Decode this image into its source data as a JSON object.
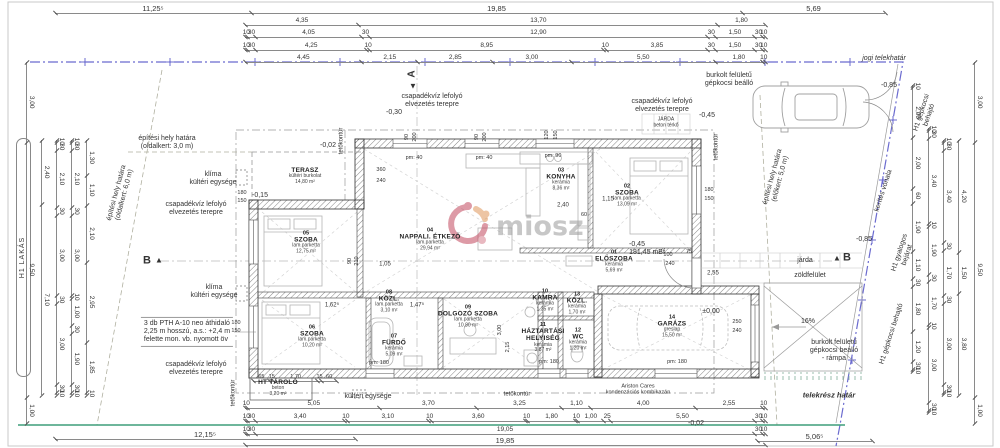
{
  "watermark": {
    "text": "miosz"
  },
  "left_pill": {
    "text": "H1 LAKÁS"
  },
  "palette": {
    "boundary_blue": "#6b6bcf",
    "terrain_green": "#3f9e7a",
    "wall_line": "#333333",
    "dim_line": "#8a8a8a",
    "furniture_gray": "#b5b5b5",
    "logo_red": "#c2485e",
    "logo_orange": "#e0975a",
    "logo_rose": "#d77f8d",
    "watermark_gray": "#9a9a9a"
  },
  "rooms": [
    {
      "num": "",
      "name": "TERASZ",
      "finish": "kültéri burkolat",
      "area": "14,80 m²",
      "x": 305,
      "y": 176
    },
    {
      "num": "05",
      "name": "SZOBA",
      "finish": "lam.parketta",
      "area": "12,75 m²",
      "x": 306,
      "y": 243
    },
    {
      "num": "04",
      "name": "NAPPALI. ÉTKEZŐ",
      "finish": "lam.parketta",
      "area": "29,94 m²",
      "x": 430,
      "y": 240
    },
    {
      "num": "03",
      "name": "KONYHA",
      "finish": "kerámia",
      "area": "8,36 m²",
      "x": 561,
      "y": 180
    },
    {
      "num": "02",
      "name": "SZOBA",
      "finish": "lam.parketta",
      "area": "13,09 m²",
      "x": 627,
      "y": 196
    },
    {
      "num": "01",
      "name": "ELŐSZOBA",
      "finish": "kerámia",
      "area": "5,69 m²",
      "x": 614,
      "y": 262
    },
    {
      "num": "06",
      "name": "SZOBA",
      "finish": "lam.parketta",
      "area": "10,20 m²",
      "x": 312,
      "y": 337
    },
    {
      "num": "08",
      "name": "KÖZL.",
      "finish": "lam.parketta",
      "area": "3,10 m²",
      "x": 389,
      "y": 302
    },
    {
      "num": "07",
      "name": "FÜRDŐ",
      "finish": "kerámia",
      "area": "5,09 m²",
      "x": 394,
      "y": 346
    },
    {
      "num": "09",
      "name": "DOLGOZÓ SZOBA",
      "finish": "lam.parketta",
      "area": "10,80 m²",
      "x": 468,
      "y": 317
    },
    {
      "num": "10",
      "name": "KAMRA",
      "finish": "kerámia",
      "area": "1,35 m²",
      "x": 545,
      "y": 301
    },
    {
      "num": "13",
      "name": "KÖZL.",
      "finish": "kerámia",
      "area": "1,70 m²",
      "x": 577,
      "y": 304
    },
    {
      "num": "11",
      "name": "HÁZTARTÁSI\nHELYISÉG",
      "finish": "kerámia",
      "area": "3,87 m²",
      "x": 543,
      "y": 338
    },
    {
      "num": "12",
      "name": "WC",
      "finish": "kerámia",
      "area": "1,20 m²",
      "x": 578,
      "y": 340
    },
    {
      "num": "14",
      "name": "GARÁZS",
      "finish": "greslap",
      "area": "15,50 m²",
      "x": 672,
      "y": 327
    },
    {
      "num": "",
      "name": "HT TÁROLÓ",
      "finish": "beton",
      "area": "3,20 m²",
      "x": 278,
      "y": 388
    }
  ],
  "dim_rows": [
    {
      "o": "h",
      "x": 55,
      "y": 4,
      "len": 830,
      "fs": 7.5,
      "vals": [
        "11,25⁵",
        "19,85",
        "5,69"
      ],
      "w": [
        196,
        491,
        143
      ]
    },
    {
      "o": "h",
      "x": 245,
      "y": 16,
      "len": 520,
      "vals": [
        "4,35",
        "13,70",
        "1,80"
      ]
    },
    {
      "o": "h",
      "x": 245,
      "y": 28,
      "len": 520,
      "vals": [
        "10",
        "30",
        "4,05",
        "30",
        "12,90",
        "30",
        "1,50",
        "30",
        "10"
      ]
    },
    {
      "o": "h",
      "x": 245,
      "y": 41,
      "len": 520,
      "vals": [
        "10",
        "30",
        "4,25",
        "10",
        "8,95",
        "10",
        "3,85",
        "30",
        "1,50",
        "30",
        "10"
      ]
    },
    {
      "o": "h",
      "x": 245,
      "y": 53,
      "len": 520,
      "vals": [
        "4,45",
        "2,15",
        "2,85",
        "3,00",
        "5,50",
        "1,80",
        "10"
      ]
    },
    {
      "o": "h",
      "x": 245,
      "y": 399,
      "len": 520,
      "vals": [
        "10",
        "5,05",
        "3,70",
        "3,25",
        "1,10",
        "4,00",
        "2,55",
        "10"
      ]
    },
    {
      "o": "h",
      "x": 245,
      "y": 412,
      "len": 520,
      "vals": [
        "10",
        "30",
        "3,40",
        "10",
        "3,10",
        "10",
        "3,60",
        "10",
        "1,80",
        "10",
        "1,00",
        "25",
        "5,50",
        "30",
        "10"
      ]
    },
    {
      "o": "h",
      "x": 245,
      "y": 425,
      "len": 520,
      "vals": [
        "10",
        "30",
        "19,05",
        "30",
        "10"
      ]
    },
    {
      "o": "h",
      "x": 245,
      "y": 436,
      "len": 520,
      "fs": 7.5,
      "vals": [
        "19,85"
      ]
    },
    {
      "o": "h",
      "x": 55,
      "y": 430,
      "len": 300,
      "fs": 7.5,
      "vals": [
        "12,15⁵"
      ]
    },
    {
      "o": "h",
      "x": 757,
      "y": 432,
      "len": 115,
      "fs": 7.5,
      "vals": [
        "5,06⁵"
      ]
    },
    {
      "o": "h",
      "x": 253,
      "y": 372,
      "len": 84,
      "fs": 5.5,
      "vals": [
        "65",
        "15",
        "1,70",
        "15",
        "60"
      ]
    },
    {
      "o": "v",
      "x": 36,
      "y": 62,
      "len": 362,
      "vals": [
        "3,00",
        "9,50",
        "1,00"
      ]
    },
    {
      "o": "v",
      "x": 51,
      "y": 140,
      "len": 255,
      "vals": [
        "2,40",
        "7,10"
      ]
    },
    {
      "o": "v",
      "x": 66,
      "y": 140,
      "len": 255,
      "vals": [
        "10",
        "30",
        "2,10",
        "30",
        "3,00",
        "30",
        "3,00",
        "30",
        "10"
      ]
    },
    {
      "o": "v",
      "x": 81,
      "y": 140,
      "len": 255,
      "vals": [
        "10",
        "30",
        "2,10",
        "30",
        "3,00",
        "10",
        "1,00",
        "30",
        "1,90",
        "30",
        "10"
      ]
    },
    {
      "o": "v",
      "x": 96,
      "y": 140,
      "len": 255,
      "vals": [
        "1,30",
        "1,10",
        "2,10",
        "2,95",
        "1,85",
        "10"
      ]
    },
    {
      "o": "v",
      "x": 984,
      "y": 62,
      "len": 362,
      "vals": [
        "3,00",
        "9,50",
        "1,00"
      ]
    },
    {
      "o": "v",
      "x": 968,
      "y": 140,
      "len": 255,
      "vals": [
        "4,20",
        "1,50",
        "3,80"
      ]
    },
    {
      "o": "v",
      "x": 953,
      "y": 140,
      "len": 255,
      "vals": [
        "10",
        "30",
        "3,40",
        "30",
        "1,70",
        "30",
        "3,00",
        "30",
        "10"
      ]
    },
    {
      "o": "v",
      "x": 938,
      "y": 128,
      "len": 285,
      "vals": [
        "10",
        "30",
        "3,40",
        "10",
        "1,90",
        "30",
        "1,70",
        "10",
        "3,00",
        "30",
        "10"
      ]
    },
    {
      "o": "v",
      "x": 922,
      "y": 85,
      "len": 287,
      "vals": [
        "10",
        "2,00",
        "2,00",
        "60",
        "1,90",
        "1,10",
        "30",
        "1,80",
        "1,20",
        "30",
        "10"
      ]
    }
  ],
  "labels": [
    {
      "n": "jogi-telekhatar-label",
      "t": "jogi telekhatár",
      "x": 884,
      "y": 59,
      "i": 1
    },
    {
      "n": "telekresz-hatar-label",
      "t": "telekrész határ",
      "x": 829,
      "y": 396,
      "b": 1,
      "i": 1,
      "fs": 7.5
    },
    {
      "n": "gepkocsi-beallo-label",
      "t": "burkolt felületű\ngépkocsi beálló",
      "x": 729,
      "y": 80
    },
    {
      "n": "elevation-minus085-top",
      "t": "-0,85",
      "x": 889,
      "y": 86
    },
    {
      "n": "elevation-minus085-mid",
      "t": "-0,85",
      "x": 864,
      "y": 240
    },
    {
      "n": "elevation-minus045-top",
      "t": "-0,45",
      "x": 707,
      "y": 116
    },
    {
      "n": "elevation-minus030",
      "t": "-0,30",
      "x": 394,
      "y": 113
    },
    {
      "n": "elevation-minus002-terasz",
      "t": "-0,02",
      "x": 328,
      "y": 146
    },
    {
      "n": "elevation-minus015-terasz",
      "t": "-0,15",
      "x": 260,
      "y": 196
    },
    {
      "n": "elevation-minus045-eloszoba",
      "t": "-0,45",
      "x": 637,
      "y": 245
    },
    {
      "n": "elevation-mbf",
      "t": "181,45 mBf",
      "x": 647,
      "y": 253
    },
    {
      "n": "elevation-garage-zero",
      "t": "±0,00",
      "x": 711,
      "y": 312
    },
    {
      "n": "elevation-minus002-bottom",
      "t": "-0,02",
      "x": 696,
      "y": 424
    },
    {
      "n": "rainwater-note-1",
      "t": "csapadékvíz lefolyó\nelvezetés terepre",
      "x": 432,
      "y": 101
    },
    {
      "n": "rainwater-note-2",
      "t": "csapadékvíz lefolyó\nelvezetés terepre",
      "x": 662,
      "y": 106
    },
    {
      "n": "rainwater-note-3",
      "t": "csapadékvíz lefolyó\nelvezetés terepre",
      "x": 196,
      "y": 209
    },
    {
      "n": "rainwater-note-4",
      "t": "csapadékvíz lefolyó\nelvezetés terepre",
      "x": 196,
      "y": 369
    },
    {
      "n": "hvac-outdoor-unit-note-1",
      "t": "klíma\nkültéri egysége",
      "x": 213,
      "y": 179
    },
    {
      "n": "hvac-outdoor-unit-note-2",
      "t": "klíma\nkültéri egysége",
      "x": 214,
      "y": 292
    },
    {
      "n": "hvac-outdoor-unit-note-3",
      "t": "kültéri egysége",
      "x": 368,
      "y": 397
    },
    {
      "n": "site-boundary-note-side3",
      "t": "építési hely határa\n(oldalkert: 3,0 m)",
      "x": 167,
      "y": 143
    },
    {
      "n": "site-boundary-note-side6",
      "t": "építési hely határa\n(oldalkert: 6,0 m)",
      "x": 121,
      "y": 194,
      "r": -75
    },
    {
      "n": "site-boundary-note-front5",
      "t": "építési hely határa\n(előkert: 5,0 m)",
      "x": 777,
      "y": 178,
      "r": -75
    },
    {
      "n": "fence-line-label",
      "t": "kerítés vonala",
      "x": 884,
      "y": 191,
      "r": -72
    },
    {
      "n": "pedestrian-entrance-label",
      "t": "H1 gyalogos\nbejárat",
      "x": 904,
      "y": 254,
      "r": -72
    },
    {
      "n": "car-entrance-label-top",
      "t": "H1 gépkocsi\nbehajtó",
      "x": 926,
      "y": 114,
      "r": -72
    },
    {
      "n": "car-entrance-label-bottom",
      "t": "H1 gépkocsi behajtó",
      "x": 892,
      "y": 334,
      "r": -72
    },
    {
      "n": "sidewalk-label",
      "t": "járda",
      "x": 805,
      "y": 261
    },
    {
      "n": "green-area-label",
      "t": "zöldfelület",
      "x": 810,
      "y": 276
    },
    {
      "n": "ramp-slope-label",
      "t": "16%",
      "x": 808,
      "y": 322
    },
    {
      "n": "ramp-label",
      "t": "burkolt felületű\ngépkocsi beálló\n- rámpa",
      "x": 834,
      "y": 351
    },
    {
      "n": "jarda-beton-label",
      "t": "JÁRDA\nbeton térkő",
      "x": 666,
      "y": 123,
      "fs": 5
    },
    {
      "n": "lintel-note",
      "t": "3 db PTH A-10 neo áthidaló\n2,25 m hosszú, a.s.: +2,4 m\nfelette mon. vb. nyomott öv",
      "x": 187,
      "y": 332,
      "al": "left",
      "box": 1
    },
    {
      "n": "boiler-note",
      "t": "Ariston Cares\nkondenzációs kombikazán",
      "x": 638,
      "y": 390,
      "fs": 5.5
    },
    {
      "n": "roof-contour-label-1",
      "t": "tetőkontúr",
      "x": 342,
      "y": 141,
      "r": -90,
      "fs": 6
    },
    {
      "n": "roof-contour-label-2",
      "t": "tetőkontúr",
      "x": 717,
      "y": 147,
      "r": -90,
      "fs": 6
    },
    {
      "n": "roof-contour-label-3",
      "t": "tetőkontúr",
      "x": 517,
      "y": 395,
      "fs": 6
    },
    {
      "n": "roof-contour-label-4",
      "t": "tetőkontúr",
      "x": 234,
      "y": 393,
      "r": -90,
      "fs": 6
    },
    {
      "n": "section-marker-b-left",
      "t": "B",
      "x": 147,
      "y": 261,
      "fs": 11,
      "b": 1
    },
    {
      "n": "section-marker-b-left-arrow",
      "t": "▲",
      "x": 159,
      "y": 260,
      "fs": 8
    },
    {
      "n": "section-marker-b-right-arrow",
      "t": "▲",
      "x": 837,
      "y": 258,
      "fs": 8
    },
    {
      "n": "section-marker-b-right",
      "t": "B",
      "x": 847,
      "y": 258,
      "fs": 11,
      "b": 1
    },
    {
      "n": "section-marker-a",
      "t": "A",
      "x": 412,
      "y": 74,
      "fs": 10,
      "b": 1,
      "r": -90
    },
    {
      "n": "section-marker-a-arrow",
      "t": "▼",
      "x": 413,
      "y": 86,
      "fs": 8
    },
    {
      "t": "90",
      "x": 407,
      "y": 137,
      "r": -90,
      "fs": 5.5
    },
    {
      "t": "200",
      "x": 415,
      "y": 137,
      "r": -90,
      "fs": 5.5
    },
    {
      "t": "90",
      "x": 477,
      "y": 137,
      "r": -90,
      "fs": 5.5
    },
    {
      "t": "200",
      "x": 485,
      "y": 137,
      "r": -90,
      "fs": 5.5
    },
    {
      "t": "120",
      "x": 547,
      "y": 135,
      "r": -90,
      "fs": 5.5
    },
    {
      "t": "150",
      "x": 556,
      "y": 135,
      "r": -90,
      "fs": 5.5
    },
    {
      "t": "pm: 40",
      "x": 414,
      "y": 158,
      "fs": 5.5
    },
    {
      "t": "pm: 40",
      "x": 484,
      "y": 158,
      "fs": 5.5
    },
    {
      "t": "pm: 90",
      "x": 553,
      "y": 156,
      "fs": 5.5
    },
    {
      "t": "180",
      "x": 709,
      "y": 190,
      "fs": 5.5
    },
    {
      "t": "150",
      "x": 709,
      "y": 199,
      "fs": 5.5
    },
    {
      "t": "180",
      "x": 242,
      "y": 193,
      "fs": 5.5
    },
    {
      "t": "150",
      "x": 242,
      "y": 201,
      "fs": 5.5
    },
    {
      "t": "180",
      "x": 236,
      "y": 323,
      "fs": 5.5
    },
    {
      "t": "150",
      "x": 236,
      "y": 331,
      "fs": 5.5
    },
    {
      "t": "pm: 180",
      "x": 379,
      "y": 363,
      "fs": 5.5
    },
    {
      "t": "pm: 180",
      "x": 549,
      "y": 362,
      "fs": 5.5
    },
    {
      "t": "pm: 180",
      "x": 677,
      "y": 362,
      "fs": 5.5
    },
    {
      "t": "250",
      "x": 737,
      "y": 322,
      "fs": 5.5
    },
    {
      "t": "240",
      "x": 737,
      "y": 331,
      "fs": 5.5
    },
    {
      "t": "360",
      "x": 381,
      "y": 170,
      "fs": 5.5
    },
    {
      "t": "240",
      "x": 381,
      "y": 181,
      "fs": 5.5
    },
    {
      "t": "2,40",
      "x": 563,
      "y": 206,
      "fs": 6
    },
    {
      "t": "60",
      "x": 584,
      "y": 215,
      "fs": 5.5
    },
    {
      "t": "1,15",
      "x": 608,
      "y": 200,
      "fs": 6
    },
    {
      "t": "1,05",
      "x": 385,
      "y": 265,
      "fs": 6
    },
    {
      "t": "1,62⁵",
      "x": 332,
      "y": 306,
      "fs": 6
    },
    {
      "t": "1,47⁵",
      "x": 417,
      "y": 306,
      "fs": 6
    },
    {
      "t": "100",
      "x": 668,
      "y": 255,
      "fs": 5.5
    },
    {
      "t": "240",
      "x": 670,
      "y": 264,
      "fs": 5.5
    },
    {
      "t": "75",
      "x": 689,
      "y": 252,
      "fs": 5.5
    },
    {
      "t": "2,55",
      "x": 713,
      "y": 274,
      "fs": 6
    },
    {
      "t": "3,00",
      "x": 500,
      "y": 330,
      "r": -90,
      "fs": 5.5
    },
    {
      "t": "2,15",
      "x": 508,
      "y": 347,
      "r": -90,
      "fs": 5.5
    },
    {
      "t": "90",
      "x": 350,
      "y": 261,
      "r": -90,
      "fs": 5.5
    },
    {
      "t": "210",
      "x": 357,
      "y": 261,
      "r": -90,
      "fs": 5.5
    }
  ]
}
